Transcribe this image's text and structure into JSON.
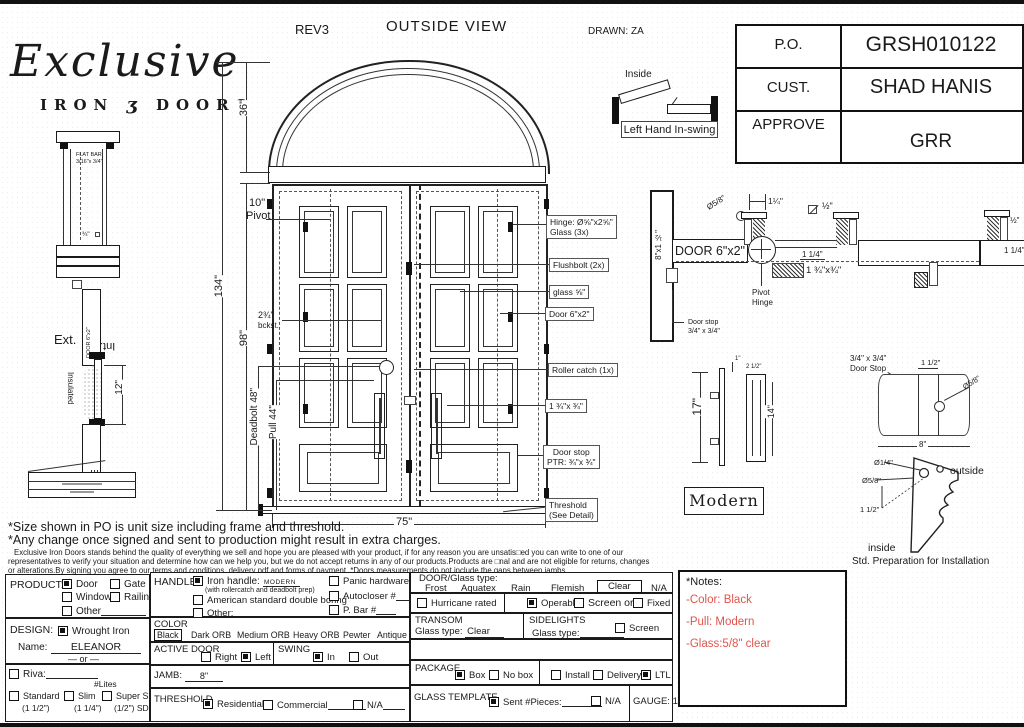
{
  "header": {
    "script": "Exclusive",
    "iron": "IRON",
    "glyph": "ʒ",
    "doors": "DOORS",
    "rev": "REV3",
    "title": "OUTSIDE VIEW",
    "drawn": "DRAWN: ZA"
  },
  "po": {
    "r1l": "P.O.",
    "r1v": "GRSH010122",
    "r2l": "CUST.",
    "r2v": "SHAD HANIS",
    "r3l": "APPROVE",
    "r3v": "GRR"
  },
  "swing_top": {
    "inside": "Inside",
    "caption": "Left Hand In-swing"
  },
  "lsec": {
    "flat1": "FLAT BAR",
    "flat2": "3/16\"x 3/4\"",
    "sq": "¾\"",
    "ext": "Ext.",
    "int": "Int.",
    "door": "DOOR 6\"x2\"",
    "insulated": "Insulated",
    "d12": "12\""
  },
  "elev": {
    "d134": "134\"",
    "d98": "98\"",
    "d36": "36\"",
    "d75": "75\"",
    "p1": "10\"",
    "p2": "Pivot",
    "b1": "2¾\"",
    "b2": "bckst.",
    "db": "Deadbolt 48\"",
    "pull": "Pull 44\""
  },
  "co": {
    "hinge1": "Hinge: Ø⅝\"x2⅝\"",
    "hinge2": "Glass (3x)",
    "flush": "Flushbolt (2x)",
    "glass": "glass ⅝\"",
    "door": "Door  6\"x2\"",
    "roller": "Roller catch  (1x)",
    "lock": "1 ¾\"x ¾\"",
    "stop1": "Door stop",
    "stop2": "PTR: ¾\"x ¾\"",
    "thr1": "Threshold",
    "thr2": "(See Detail)"
  },
  "hsec": {
    "jamb": "8\"x1 ½\"",
    "door": "DOOR 6\"x2\"",
    "dia": "Ø5/8\"",
    "d114": "1¼\"",
    "half": "½\"",
    "d114b": "1 1/4\"",
    "block": "1 ¾\"x¾\"",
    "piv1": "Pivot",
    "piv2": "Hinge",
    "ds1": "Door stop",
    "ds2": "3/4\" x 3/4\"",
    "rhalf": "½\"",
    "r114": "1 1/4\""
  },
  "handle": {
    "d17": "17\"",
    "d14": "14\"",
    "d212": "2 1/2\"",
    "d1": "1\"",
    "caption": "Modern"
  },
  "stopd": {
    "l1": "3/4\" x 3/4\"",
    "l2": "Door Stop",
    "d112": "1 1/2\"",
    "dia": "Ø5/8\"",
    "d8": "8\""
  },
  "inst": {
    "dia14": "Ø1/4\"",
    "dia58": "Ø5/8\"",
    "d112": "1 1/2\"",
    "outside": "outside",
    "inside": "inside",
    "caption": "Std. Preparation for Installation"
  },
  "disc": {
    "l1": "*Size shown in PO is unit size including frame and threshold.",
    "l2": "*Any change once signed and sent to production might result in extra charges.",
    "l3": "Exclusive Iron Doors stands behind the quality of everything we sell and hope you are pleased with your product, if for any reason you are unsatis□ed you can write to one of our",
    "l4": "representatives to verify your situation and determine how can we help you, but we do not accept returns in any of our products.Products are □nal and are not eligible for returns, changes",
    "l5": "or alterations.By signing you agree to our terms and conditions, delivery pdf and forms of payment.  *Doors measurements do not include the gaps between jambs"
  },
  "form": {
    "product": {
      "label": "PRODUCT:",
      "door": "Door",
      "gate": "Gate",
      "window": "Window",
      "railing": "Railing",
      "other": "Other"
    },
    "design": {
      "label": "DESIGN:",
      "wrought": "Wrought Iron",
      "name_label": "Name:",
      "name_value": "ELEANOR",
      "or": "or",
      "riva": "Riva:",
      "lites": "#Lites",
      "std1": "Standard",
      "std2": "(1 1/2\")",
      "slim1": "Slim",
      "slim2": "(1 1/4\")",
      "ss1": "Super Slim",
      "ss2": "(1/2\") SDL"
    },
    "handle": {
      "label": "HANDLE",
      "iron": "Iron handle:",
      "iron_value": "MODERN",
      "iron_sub": "(with rollercatch and deadbolt prep)",
      "american": "American standard double boring",
      "other": "Other:",
      "panic": "Panic hardware",
      "autocloser": "Autocloser #",
      "pbar": "P. Bar #"
    },
    "color": {
      "label": "COLOR",
      "black": "Black",
      "dark": "Dark ORB",
      "medium": "Medium ORB",
      "heavy": "Heavy ORB",
      "pewter": "Pewter",
      "antique": "Antique gold"
    },
    "active": {
      "label": "ACTIVE DOOR",
      "right": "Right",
      "left": "Left"
    },
    "swing": {
      "label": "SWING",
      "in": "In",
      "out": "Out"
    },
    "jamb": {
      "label": "JAMB:",
      "value": "8\""
    },
    "threshold": {
      "label": "THRESHOLD",
      "res": "Residential",
      "com": "Commercial",
      "na": "N/A"
    },
    "glass": {
      "label": "DOOR/Glass type:",
      "frost": "Frost",
      "aquatex": "Aquatex",
      "rain": "Rain",
      "flemish": "Flemish",
      "clear": "Clear",
      "na": "N/A",
      "hurricane": "Hurricane rated",
      "operable": "Operable",
      "screen_or": "Screen or",
      "fixed": "Fixed"
    },
    "transom": {
      "label": "TRANSOM",
      "glass_type": "Glass type:",
      "value": "Clear"
    },
    "sidelights": {
      "label": "SIDELIGHTS",
      "glass_type": "Glass type:",
      "screen": "Screen"
    },
    "package": {
      "label": "PACKAGE",
      "box": "Box",
      "nobox": "No box",
      "install": "Install",
      "delivery": "Delivery",
      "ltl": "LTL"
    },
    "template": {
      "label": "GLASS TEMPLATE",
      "sent": "Sent #Pieces:",
      "na": "N/A",
      "gauge": "GAUGE: 14"
    }
  },
  "notes": {
    "title": "*Notes:",
    "n1": "-Color: Black",
    "n2": "-Pull: Modern",
    "n3": "-Glass:5/8\"  clear"
  }
}
